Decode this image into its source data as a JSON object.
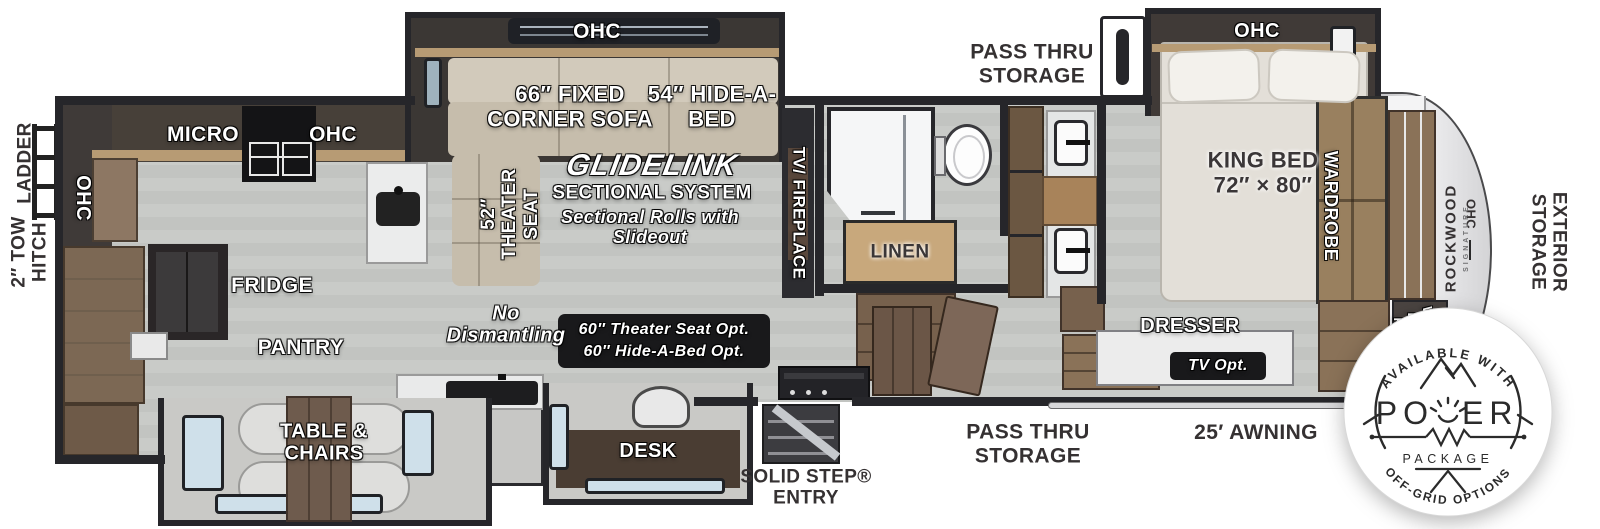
{
  "exterior": {
    "ladder": "LADDER",
    "tow_hitch": "2″ TOW\nHITCH",
    "exterior_storage": "EXTERIOR\nSTORAGE",
    "pass_thru_top": "PASS THRU\nSTORAGE",
    "pass_thru_bottom": "PASS THRU\nSTORAGE",
    "awning": "25′ AWNING",
    "entry": "SOLID STEP®\nENTRY",
    "brand": "ROCKWOOD",
    "brand_sub": "SIGNATURE"
  },
  "kitchen": {
    "ohc_left": "OHC",
    "micro": "MICRO",
    "ohc_top": "OHC",
    "fridge": "FRIDGE",
    "pantry": "PANTRY"
  },
  "dining": {
    "table_chairs": "TABLE &\nCHAIRS"
  },
  "living": {
    "ohc": "OHC",
    "corner_sofa": "66″ FIXED\nCORNER SOFA",
    "hide_a_bed": "54″ HIDE-A-\nBED",
    "theater_seat": "52″\nTHEATER\nSEAT",
    "glidelink": "GLIDELINK",
    "sectional_system": "SECTIONAL SYSTEM",
    "sectional_note": "Sectional Rolls with\nSlideout",
    "no_dismantling": "No\nDismantling",
    "options_badge": "60″ Theater Seat Opt.\n60″ Hide-A-Bed Opt.",
    "tv_fireplace": "TV/ FIREPLACE",
    "desk": "DESK"
  },
  "bath": {
    "linen": "LINEN"
  },
  "bedroom": {
    "ohc": "OHC",
    "king_bed": "KING BED\n72″ × 80″",
    "wardrobe": "WARDROBE",
    "dresser": "DRESSER",
    "tv_opt": "TV Opt.",
    "wd_prep": "WASHER\nDRYER\nPREP",
    "ohc_front": "OHC"
  },
  "power_badge": {
    "top": "AVAILABLE WITH",
    "power_left": "PO",
    "power_right": "ER",
    "package": "PACKAGE",
    "bottom": "OFF-GRID OPTIONS"
  },
  "colors": {
    "wall": "#26262a",
    "floor": "#c9cbc8",
    "sofa": "#c6bdac",
    "wood": "#8a7258",
    "counter": "#ebecec",
    "badge_bg": "#19191b",
    "window": "#cfe0ea"
  }
}
